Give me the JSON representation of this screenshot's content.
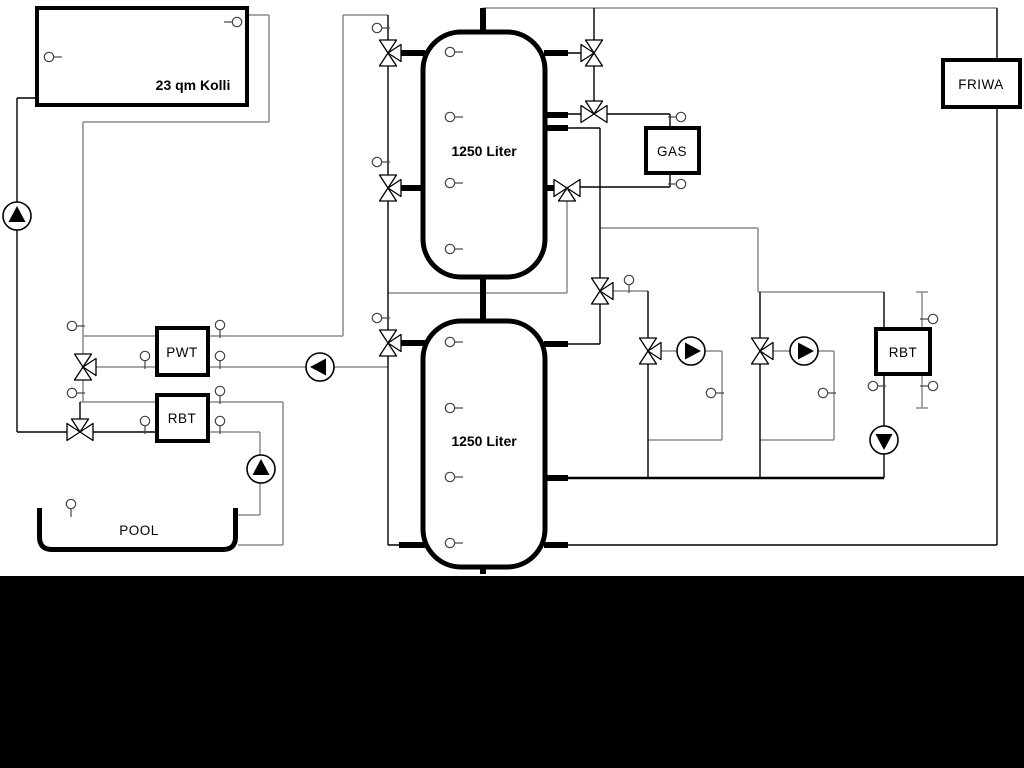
{
  "labels": {
    "collector": "23 qm Kolli",
    "buffer_tank_top": "1250 Liter",
    "buffer_tank_bottom": "1250 Liter",
    "pwt": "PWT",
    "rbt_pool": "RBT",
    "rbt_right": "RBT",
    "gas": "GAS",
    "friwa": "FRIWA",
    "pool": "POOL"
  },
  "colors": {
    "background": "#ffffff",
    "pipe_gray": "#8a8a8a",
    "pipe_black": "#000000",
    "equipment_border": "#000000",
    "bottom_bar": "#000000"
  }
}
